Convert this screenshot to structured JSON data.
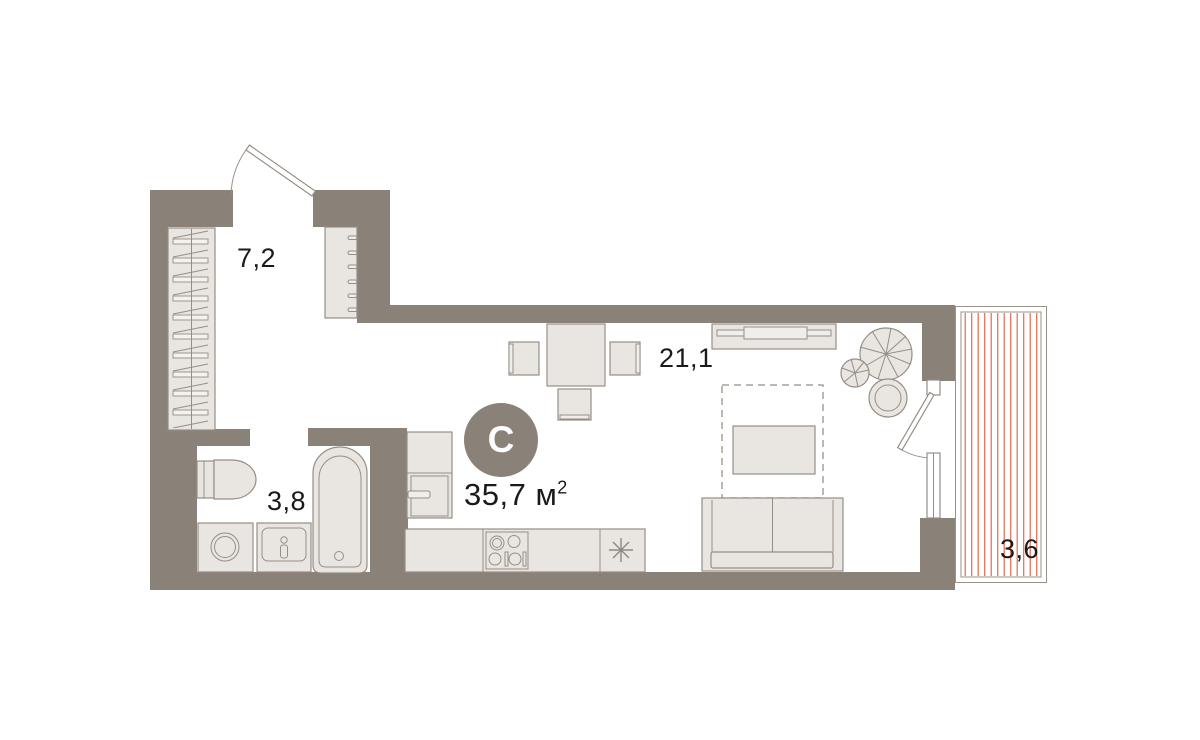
{
  "floorplan": {
    "compass": {
      "label": "С"
    },
    "title": {
      "value": "35,7",
      "unit": "м",
      "sup": "2"
    },
    "rooms": {
      "hallway": {
        "area": "7,2"
      },
      "bathroom": {
        "area": "3,8"
      },
      "living": {
        "area": "21,1"
      },
      "balcony": {
        "area": "3,6"
      }
    },
    "colors": {
      "background": "#ffffff",
      "wall": "#8a8178",
      "furniture_fill": "#e9e6e1",
      "furniture_stroke": "#958e85",
      "balcony_hatch": "#e8684c",
      "text": "#1c1a18"
    }
  }
}
